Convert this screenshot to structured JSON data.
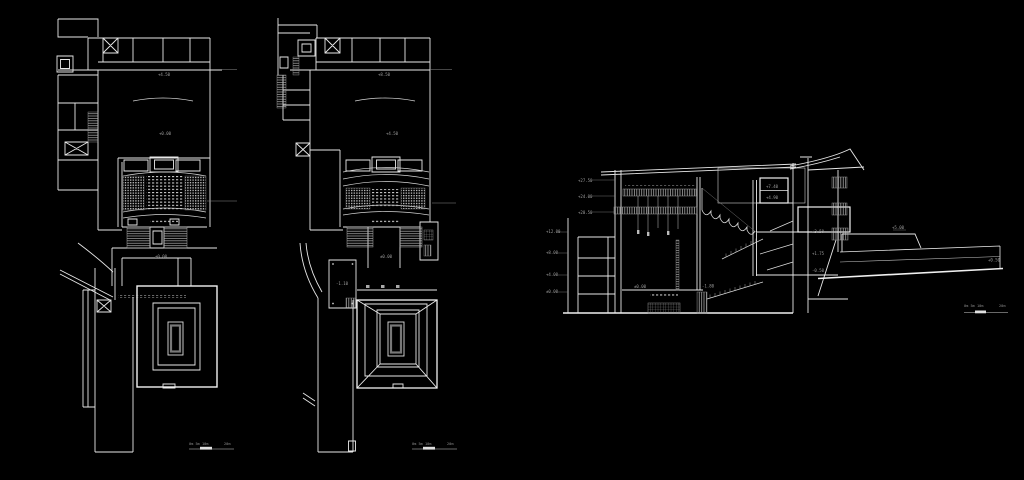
{
  "colors": {
    "background": "#000000",
    "line": "#e8e8e8",
    "bright_line": "#f2f2f2",
    "dim_line": "#8a8a8a",
    "annotation": "#9f9f9f"
  },
  "scale_bar": {
    "labels_left": "0m 5m 10m",
    "label_right": "20m"
  },
  "plan_upper": {
    "corridor_level": "+4.50",
    "foyer_level": "+0.00",
    "stage_level": "±0.00"
  },
  "plan_lower": {
    "corridor_level": "+8.50",
    "foyer_level": "+4.50",
    "stage_level": "±0.00",
    "room_level": "-1.10"
  },
  "section": {
    "levels_left_upper": [
      {
        "label": "+27.50"
      },
      {
        "label": "+24.00"
      },
      {
        "label": "+20.50"
      }
    ],
    "levels_left_lower": [
      {
        "label": "+12.00"
      },
      {
        "label": "+8.00"
      },
      {
        "label": "+4.00"
      },
      {
        "label": "±0.00"
      }
    ],
    "levels_mid": [
      {
        "label": "+7.40"
      },
      {
        "label": "+4.90"
      }
    ],
    "levels_right": [
      {
        "label": "+3.50"
      },
      {
        "label": "+1.75"
      },
      {
        "label": "-0.50"
      }
    ],
    "levels_stage": [
      {
        "label": "±0.00"
      },
      {
        "label": "-1.80"
      }
    ],
    "ramp_labels": {
      "upper": "+5.00",
      "end": "+0.50"
    }
  }
}
